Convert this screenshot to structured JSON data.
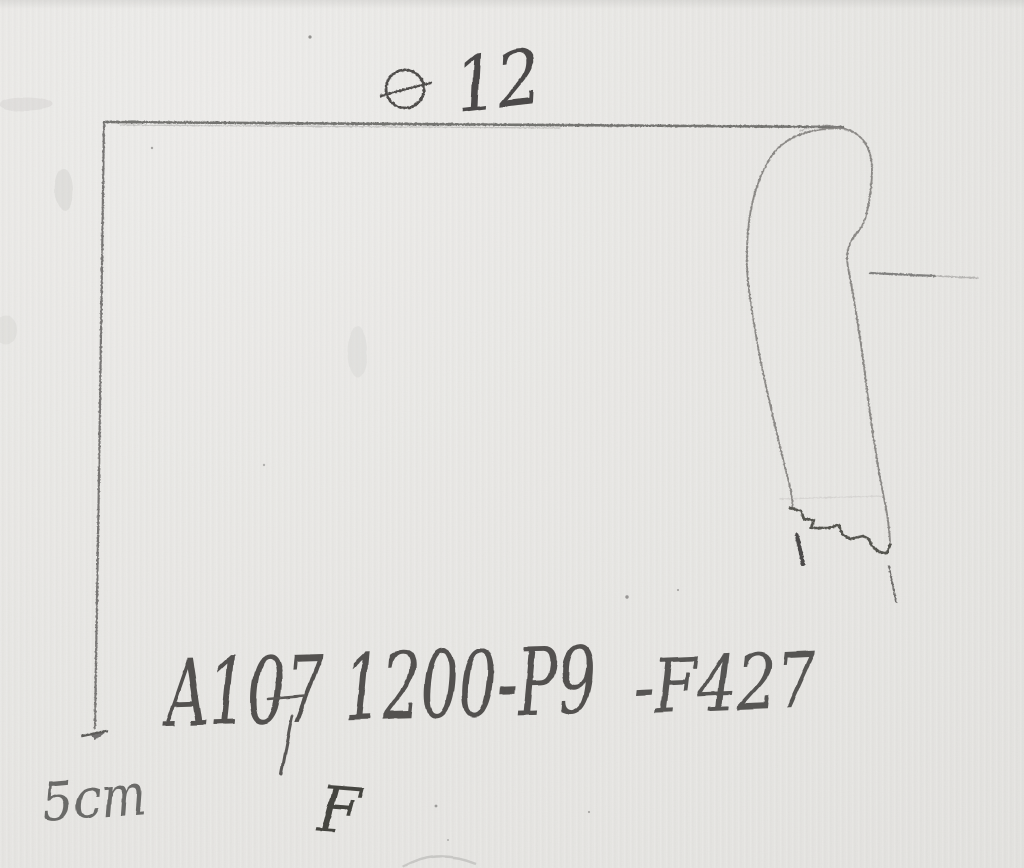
{
  "annotations": {
    "diameter": {
      "symbol": "⌀",
      "icon": "diameter-icon",
      "value": "12"
    },
    "scale": {
      "label": "5cm"
    },
    "catalog": {
      "site_code": "A107 1200-P9",
      "find_code": "-F427",
      "letter": "F"
    }
  },
  "drawing": {
    "subject": "pottery-rim-profile-sketch"
  },
  "colors": {
    "paper": "#e8e7e4",
    "pencil_light": "#84827f",
    "pencil_mid": "#6b6a68",
    "pencil_dark": "#4c4a48"
  }
}
